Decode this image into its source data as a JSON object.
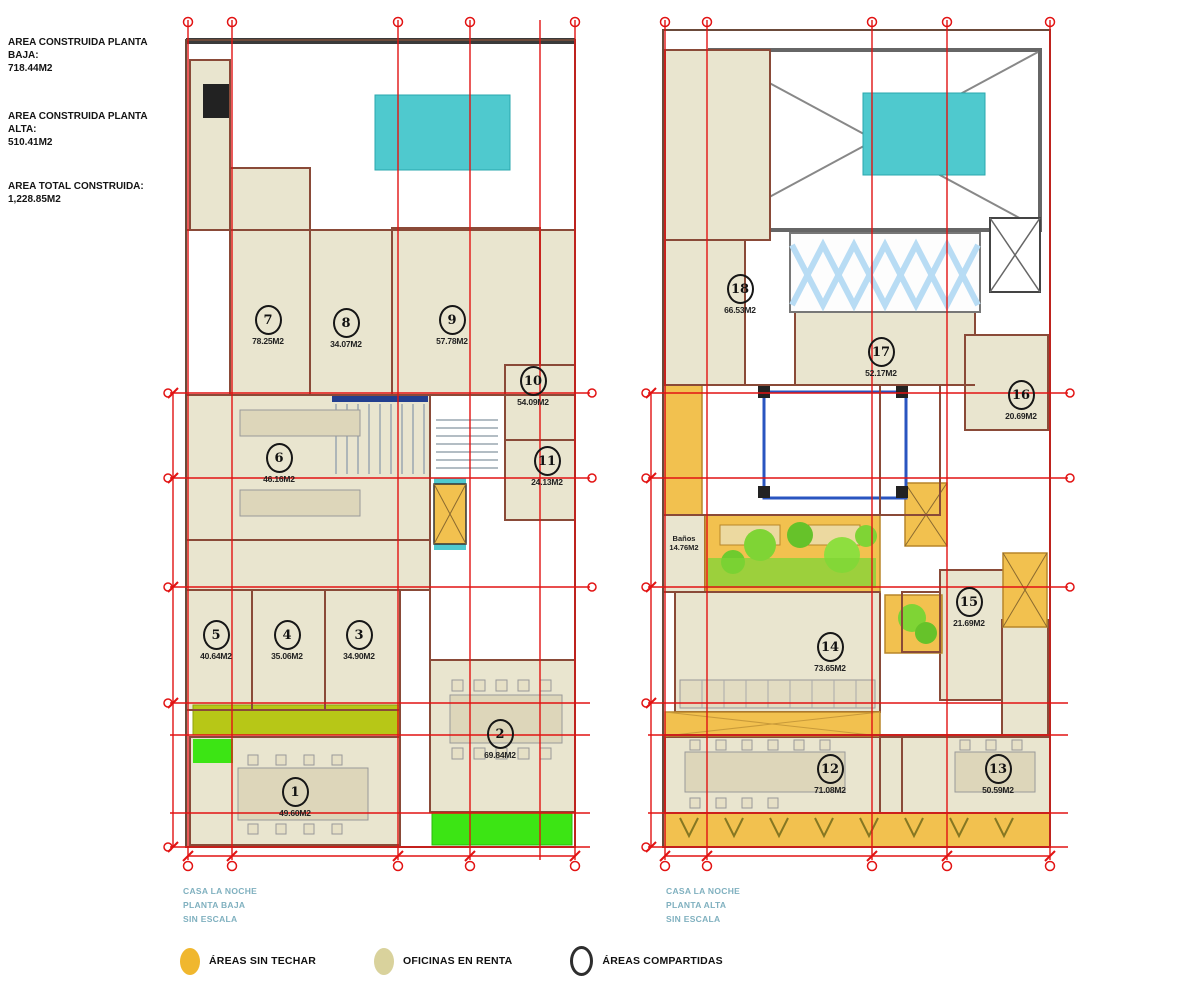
{
  "info": {
    "lines": [
      {
        "label": "AREA CONSTRUIDA PLANTA BAJA:",
        "value": "718.44M2"
      },
      {
        "label": "AREA CONSTRUIDA PLANTA ALTA:",
        "value": "510.41M2"
      },
      {
        "label": "AREA TOTAL CONSTRUIDA:",
        "value": "1,228.85M2"
      }
    ]
  },
  "plans": [
    {
      "name": "planta-baja",
      "caption": {
        "line1": "CASA LA NOCHE",
        "line2": "PLANTA BAJA",
        "line3": "SIN ESCALA"
      },
      "rooms": [
        {
          "number": "1",
          "area": "49.60M2"
        },
        {
          "number": "2",
          "area": "69.84M2"
        },
        {
          "number": "3",
          "area": "34.90M2"
        },
        {
          "number": "4",
          "area": "35.06M2"
        },
        {
          "number": "5",
          "area": "40.64M2"
        },
        {
          "number": "6",
          "area": "46.16M2"
        },
        {
          "number": "7",
          "area": "78.25M2"
        },
        {
          "number": "8",
          "area": "34.07M2"
        },
        {
          "number": "9",
          "area": "57.78M2"
        },
        {
          "number": "10",
          "area": "54.09M2"
        },
        {
          "number": "11",
          "area": "24.13M2"
        }
      ]
    },
    {
      "name": "planta-alta",
      "caption": {
        "line1": "CASA LA NOCHE",
        "line2": "PLANTA ALTA",
        "line3": "SIN ESCALA"
      },
      "rooms": [
        {
          "number": "12",
          "area": "71.08M2"
        },
        {
          "number": "13",
          "area": "50.59M2"
        },
        {
          "number": "14",
          "area": "73.65M2"
        },
        {
          "number": "15",
          "area": "21.69M2"
        },
        {
          "number": "16",
          "area": "20.69M2"
        },
        {
          "number": "17",
          "area": "52.17M2"
        },
        {
          "number": "18",
          "area": "66.53M2"
        }
      ],
      "banos": {
        "label": "Baños",
        "area": "14.76M2"
      }
    }
  ],
  "legend": {
    "items": [
      {
        "label": "ÁREAS SIN TECHAR",
        "swatch": "orange-filled-circle"
      },
      {
        "label": "OFICINAS EN RENTA",
        "swatch": "beige-filled-circle"
      },
      {
        "label": "ÁREAS COMPARTIDAS",
        "swatch": "outlined-circle"
      }
    ]
  },
  "colors": {
    "grid_red": "#e21313",
    "office_beige": "#e9e5cf",
    "uncovered_orange": "#f2c14f",
    "pool_teal": "#4fc9ce",
    "grass_green": "#3ce514",
    "lawn_olive": "#b7c717",
    "caption_blue": "#7fb0bf",
    "legend_orange": "#f0b72e",
    "legend_beige": "#d9d29c"
  }
}
